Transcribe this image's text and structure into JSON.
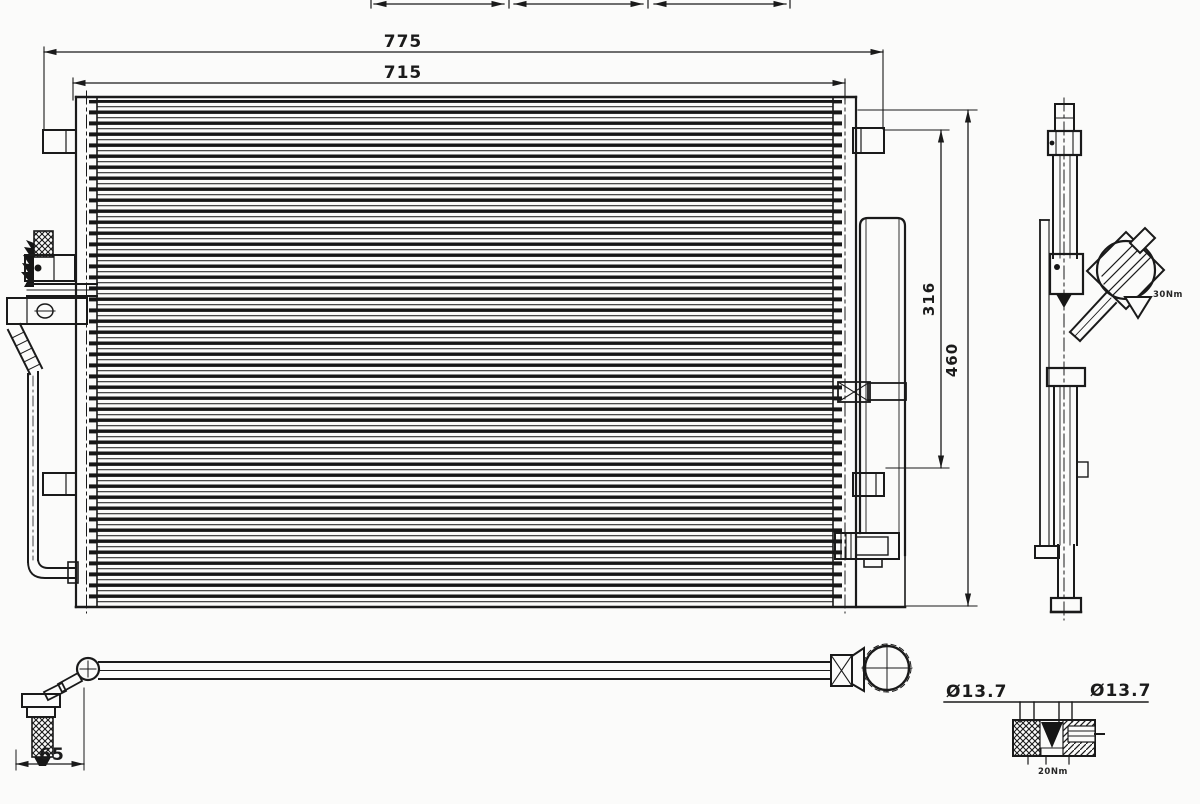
{
  "drawing": {
    "type": "technical-line-drawing",
    "subject": "air-conditioning condenser with receiver drier, side profile and hose assembly",
    "background_color": "#fbfbfa",
    "line_color": "#1a1a1a",
    "dimensions": {
      "overall_width": "775",
      "core_width": "715",
      "bracket_span_height": "316",
      "overall_height": "460",
      "hose_elbow_offset": "65",
      "port_diameter_left": "Ø13.7",
      "port_diameter_right": "Ø13.7"
    },
    "annotations": {
      "side_view_note": "30Nm",
      "port_detail_note": "20Nm"
    }
  }
}
